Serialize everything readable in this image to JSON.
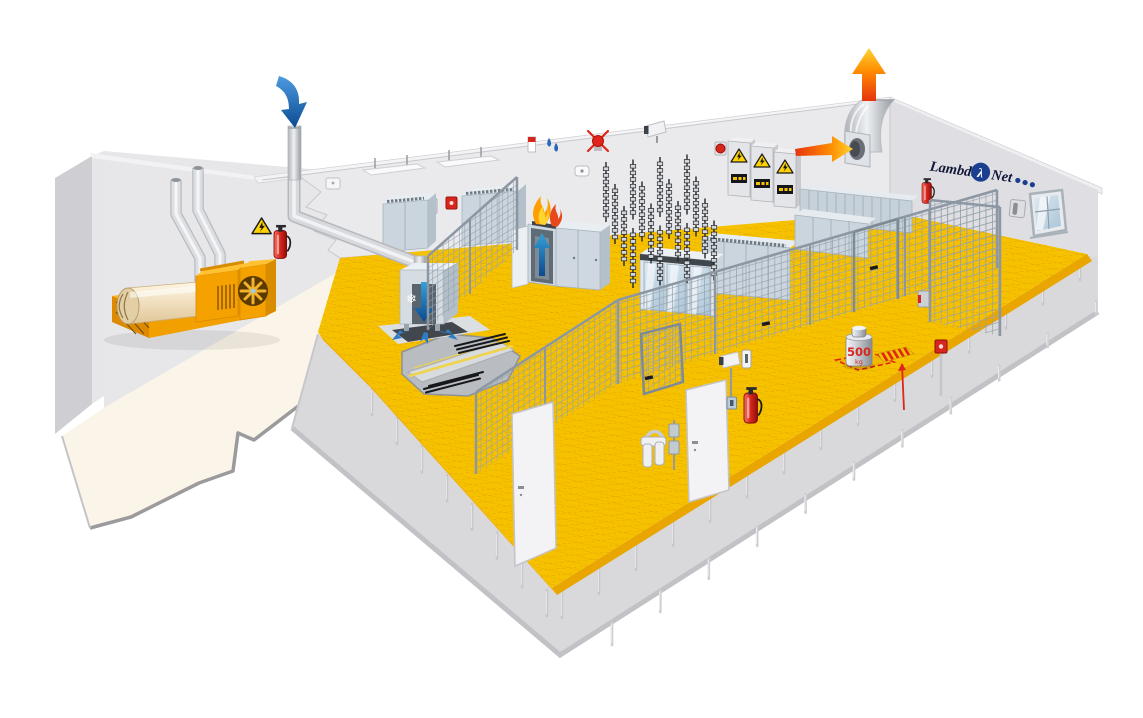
{
  "illustration": {
    "kind": "isometric-cutaway-drawing",
    "subject": "data-center machine room with raised floor, cooling, power and security equipment",
    "logo": {
      "prefix": "Lambda",
      "lambda_symbol": "λ",
      "suffix": "Net",
      "dot_count": 3
    },
    "floor_load_label": {
      "value": "500",
      "unit": "kg"
    },
    "icons": {
      "snowflake": "❄"
    },
    "colors": {
      "raised_floor": "#F6C200",
      "floor_grid": "#DF9E00",
      "floor_edge": "#E9A600",
      "back_wall": "#EAEAED",
      "right_wall": "#DFDFE3",
      "concrete": "#D9D9DC",
      "cream_floor": "#FBF5E9",
      "generator_orange": "#F5A200",
      "rack_gray": "#CBD5DD",
      "mesh_gray": "#96A2AE",
      "cold_air_blue": "#1B6FBA",
      "hot_air_red": "#E5330F",
      "hot_air_yellow": "#FFD431",
      "alarm_red": "#D7261D",
      "logo_navy": "#1B3F8F",
      "logo_text": "#101737"
    }
  }
}
